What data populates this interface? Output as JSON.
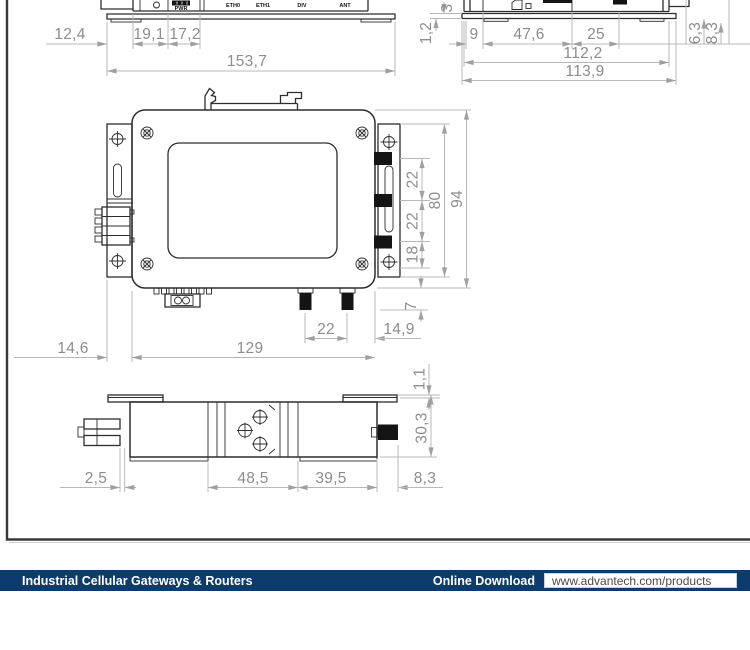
{
  "meta": {
    "accent_color": "#0b3c6d",
    "dim_text_color": "#8d8d8d",
    "drawing_line_color": "#2d2d2d"
  },
  "front_view": {
    "ports": [
      "PWR",
      "ETH0",
      "ETH1",
      "DIV",
      "ANT"
    ],
    "dims": {
      "led_offset": "12,4",
      "pwr_block": "19,1",
      "eth_block": "17,2",
      "overall_width": "153,7"
    }
  },
  "side_view": {
    "dims": {
      "foot_height": "1,2",
      "clipped_top": "3",
      "edge": "9",
      "sim_offset": "47,6",
      "slot": "25",
      "body_width": "112,2",
      "overall_width": "113,9",
      "conn_a": "6,3",
      "conn_b": "8,3"
    }
  },
  "rear_view": {
    "dims": {
      "ant_spacing_top": "22",
      "ant_spacing_mid": "22",
      "ant_offset_bottom": "18",
      "bracket_height": "80",
      "overall_height": "94",
      "conn_protrusion": "7",
      "sma_spacing": "22",
      "sma_edge_offset": "14,9",
      "bracket_overhang": "14,6",
      "body_width": "129",
      "plate_thickness": "1,1"
    }
  },
  "bottom_view": {
    "dims": {
      "conn_offset": "2,5",
      "center_width": "48,5",
      "right_width": "39,5",
      "conn_protrusion": "8,3",
      "overall_depth": "30,3"
    }
  },
  "footer": {
    "category": "Industrial Cellular Gateways & Routers",
    "download_label": "Online Download",
    "url": "www.advantech.com/products"
  }
}
